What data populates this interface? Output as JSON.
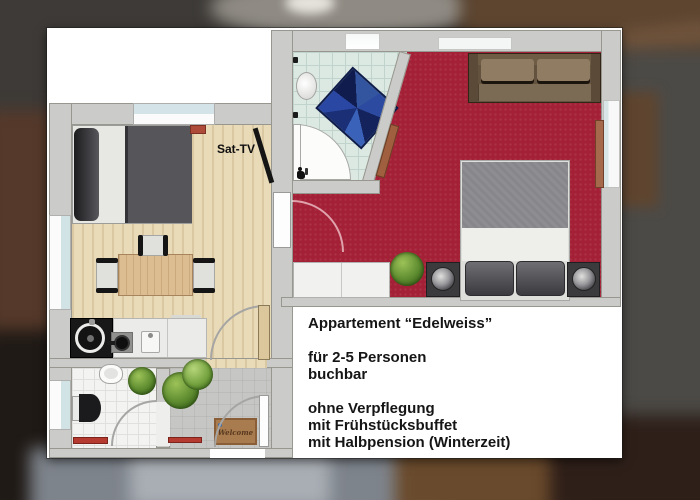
{
  "floorplan": {
    "room_label": "Sat-TV",
    "welcome_mat": "Welcome"
  },
  "info_box": {
    "title": "Appartement “Edelweiss”",
    "lines": [
      "für 2-5 Personen",
      "buchbar",
      "ohne Verpflegung",
      "mit Frühstücksbuffet",
      "mit Halbpension (Winterzeit)"
    ]
  },
  "icons": {
    "shower_sign": "shower-person-icon",
    "door_swings": "quarter-circle-arc",
    "flower": "blue-flower-dot"
  },
  "colors": {
    "carpet_red": "#a32036",
    "wood_floor": "#e9dab8",
    "bath_tile": "#dce8e2",
    "wall_gray": "#cbcbc9",
    "rug_blue": "#1b2f77",
    "sofa_brown": "#7c6b54",
    "radiator_red": "#b53a30",
    "welcome_mat_brown": "#a87c4e",
    "info_text": "#151515",
    "card_white": "#ffffff"
  }
}
